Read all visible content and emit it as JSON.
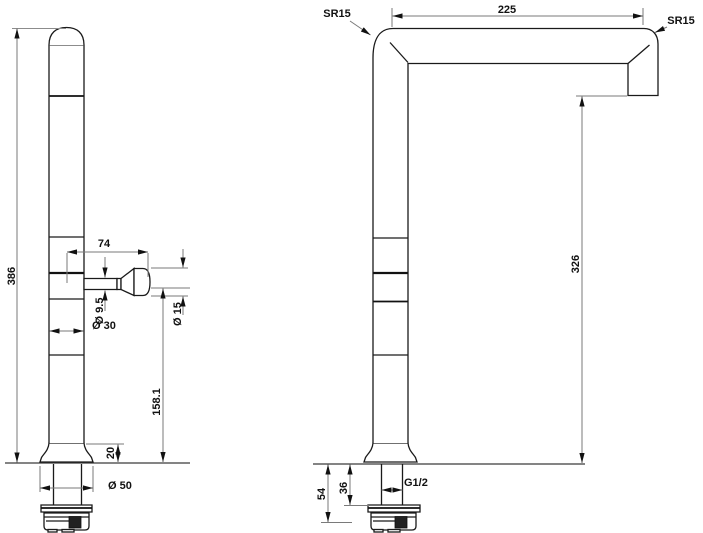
{
  "drawing": {
    "left_view": {
      "overall_height": "386",
      "handle_reach": "74",
      "handle_stem_diameter": "Ø 9.5",
      "body_diameter": "Ø 30",
      "handle_knob_diameter": "Ø 15",
      "handle_height_above_deck": "158.1",
      "base_height": "20",
      "base_diameter": "Ø 50"
    },
    "right_view": {
      "corner_radius": "SR15",
      "spout_reach": "225",
      "tip_radius": "SR15",
      "spout_outlet_height": "326",
      "shank_to_washer": "36",
      "shank_total": "54",
      "thread_size": "G1/2"
    }
  }
}
